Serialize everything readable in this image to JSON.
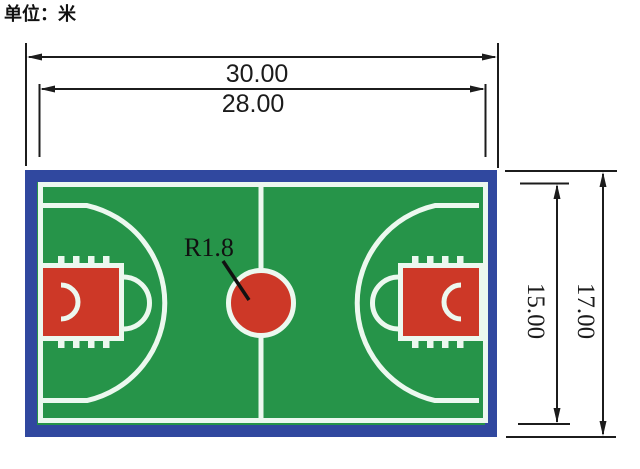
{
  "title": {
    "unit_label": "单位：米"
  },
  "dimensions": {
    "outer_length_m": "30.00",
    "inner_length_m": "28.00",
    "inner_width_m": "15.00",
    "outer_width_m": "17.00",
    "center_circle_radius": "R1.8"
  },
  "court": {
    "description": "basketball-court-plan-view",
    "features": [
      "blue-apron-border",
      "green-playing-surface",
      "white-boundary-line",
      "center-line",
      "red-center-circle",
      "left-three-point-line",
      "right-three-point-line",
      "left-key-painted-area",
      "right-key-painted-area",
      "free-throw-semicircles",
      "no-charge-semicircles",
      "lane-tick-marks"
    ]
  },
  "colors": {
    "border_blue": "#30489f",
    "court_green": "#269449",
    "paint_red": "#cd3827",
    "line_white": "#ecf8ef",
    "dimension_black": "#1c1c1c"
  }
}
